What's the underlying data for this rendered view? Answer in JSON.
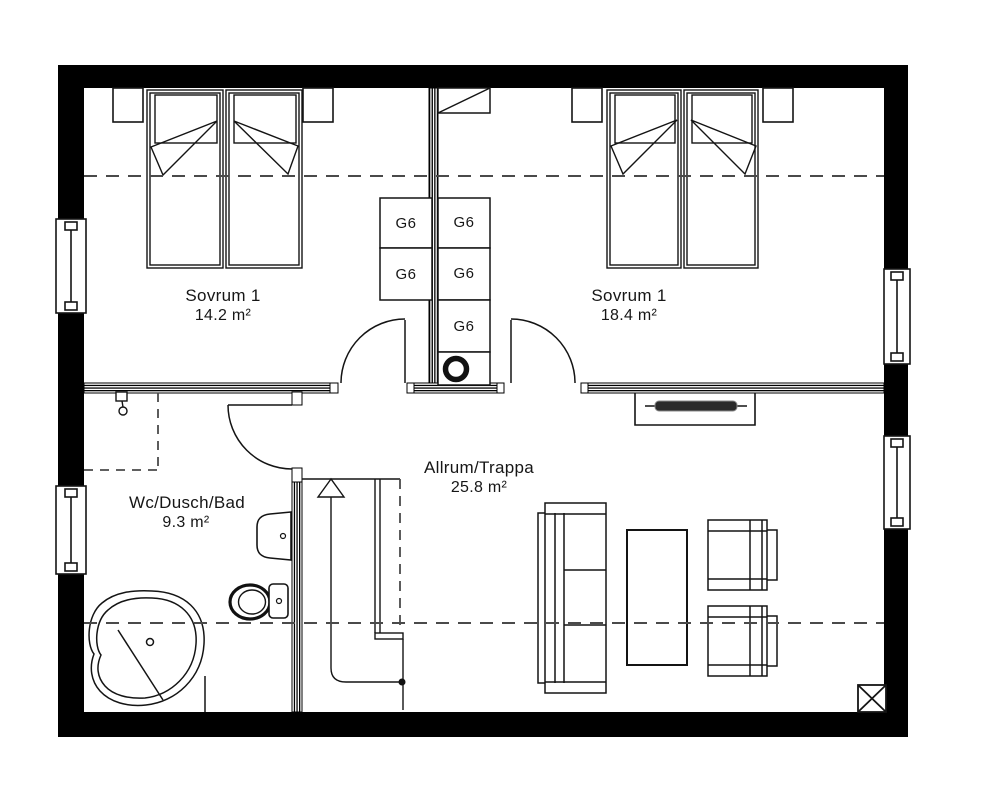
{
  "rooms": {
    "bedroom_left": {
      "name": "Sovrum 1",
      "area": "14.2 m²"
    },
    "bedroom_right": {
      "name": "Sovrum 1",
      "area": "18.4 m²"
    },
    "living": {
      "name": "Allrum/Trappa",
      "area": "25.8 m²"
    },
    "bath": {
      "name": "Wc/Dusch/Bad",
      "area": "9.3 m²"
    }
  },
  "closets": {
    "labels": [
      "G6",
      "G6",
      "G6",
      "G6",
      "G6"
    ]
  },
  "colors": {
    "wall": "#000000",
    "line": "#141414",
    "dash": "#4a4a4a",
    "background": "#ffffff"
  }
}
